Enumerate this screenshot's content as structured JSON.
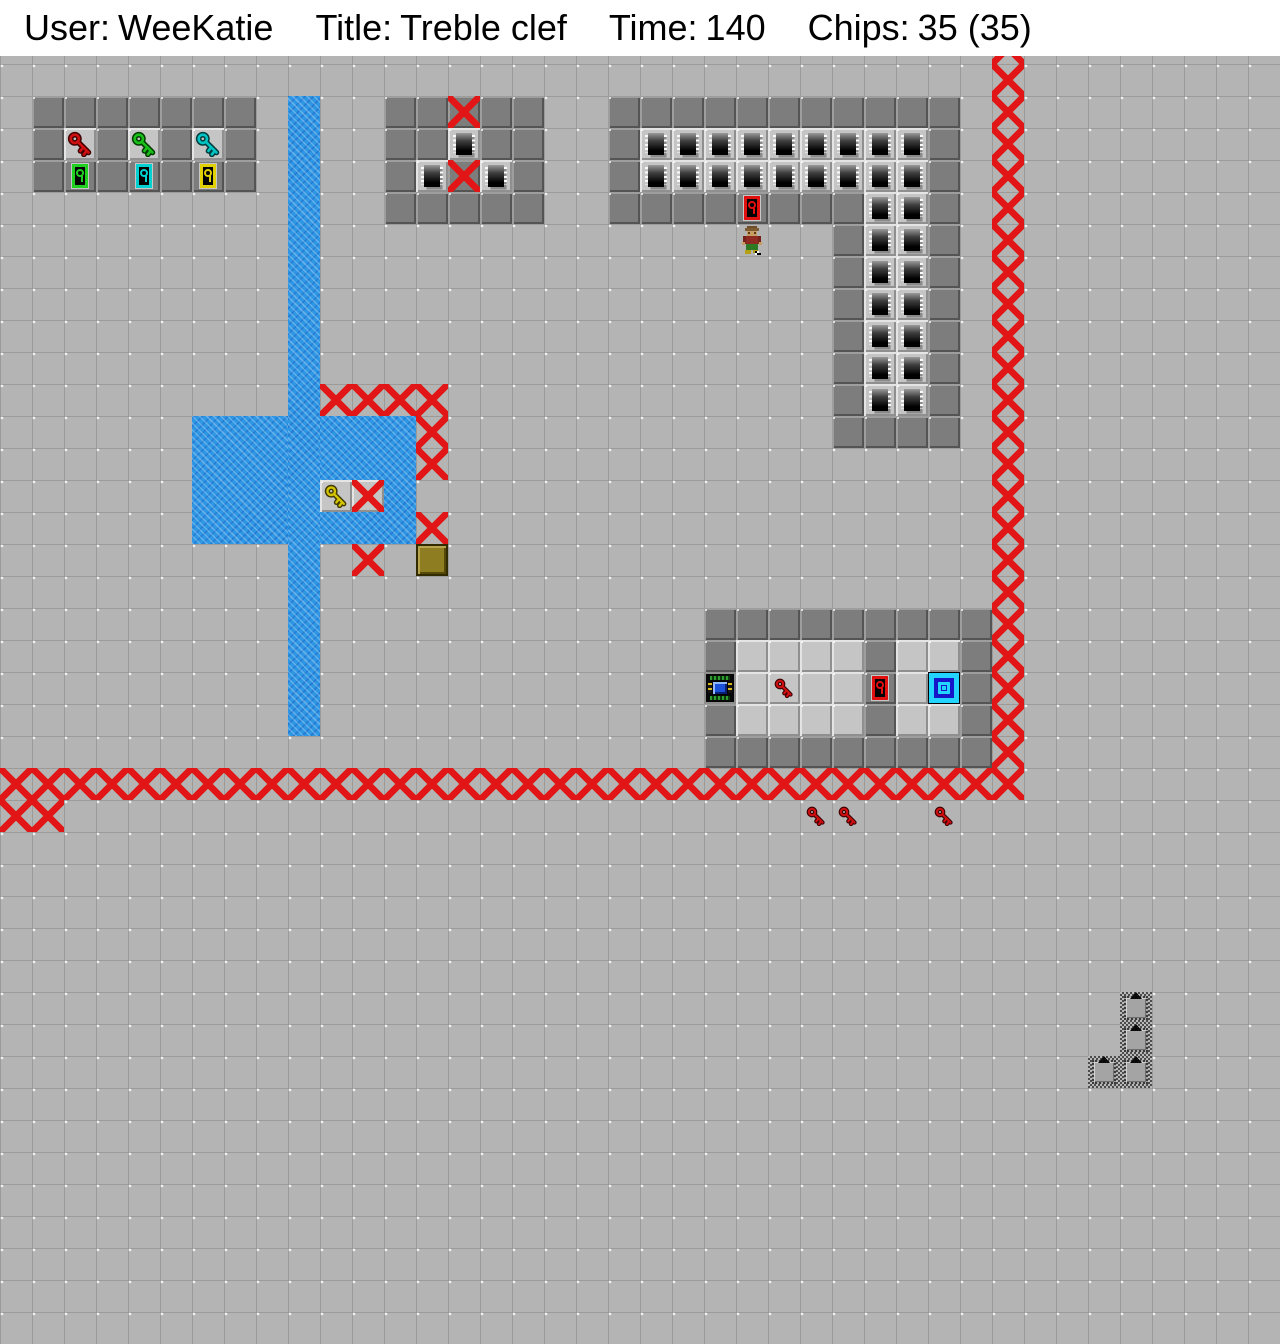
{
  "header": {
    "user_label": "User:",
    "user_value": "WeeKatie",
    "title_label": "Title:",
    "title_value": "Treble clef",
    "time_label": "Time:",
    "time_value": "140",
    "chips_label": "Chips:",
    "chips_value": "35 (35)"
  },
  "board": {
    "tile_size": 32,
    "cols": 40,
    "rows": 40,
    "colors": {
      "floor": "#b4b4b4",
      "room_floor": "#c5c5c5",
      "wall": "#7d7d7d",
      "x_marker": "#e21616",
      "water": "#2f96e4",
      "key_red": "#d01010",
      "key_green": "#18c018",
      "key_cyan": "#00c4c4",
      "key_yellow": "#d4c400",
      "lock_red": "#e01010",
      "lock_green": "#20d020",
      "lock_cyan": "#00d0d0",
      "lock_yellow": "#e0d000",
      "teleport_cyan": "#22d4ff",
      "teleport_blue": "#1616c8",
      "dirt": "#8f7d22"
    },
    "water_rects": [
      {
        "c": 9,
        "r": 1,
        "w": 1,
        "h": 20
      },
      {
        "c": 6,
        "r": 11,
        "w": 3,
        "h": 4
      },
      {
        "c": 10,
        "r": 11,
        "w": 3,
        "h": 4
      }
    ],
    "walls_h": [
      [
        1,
        7,
        1
      ],
      [
        1,
        1,
        2
      ],
      [
        3,
        3,
        2
      ],
      [
        5,
        5,
        2
      ],
      [
        7,
        7,
        2
      ],
      [
        1,
        1,
        3
      ],
      [
        3,
        3,
        3
      ],
      [
        5,
        5,
        3
      ],
      [
        7,
        7,
        3
      ],
      [
        12,
        13,
        1
      ],
      [
        15,
        16,
        1
      ],
      [
        12,
        13,
        2
      ],
      [
        15,
        16,
        2
      ],
      [
        12,
        12,
        3
      ],
      [
        16,
        16,
        3
      ],
      [
        12,
        16,
        4
      ],
      [
        19,
        29,
        1
      ],
      [
        19,
        19,
        2
      ],
      [
        29,
        29,
        2
      ],
      [
        19,
        19,
        3
      ],
      [
        29,
        29,
        3
      ],
      [
        19,
        22,
        4
      ],
      [
        24,
        26,
        4
      ],
      [
        29,
        29,
        4
      ],
      [
        26,
        26,
        5
      ],
      [
        29,
        29,
        5
      ],
      [
        26,
        26,
        6
      ],
      [
        29,
        29,
        6
      ],
      [
        26,
        26,
        7
      ],
      [
        29,
        29,
        7
      ],
      [
        26,
        26,
        8
      ],
      [
        29,
        29,
        8
      ],
      [
        26,
        26,
        9
      ],
      [
        29,
        29,
        9
      ],
      [
        26,
        26,
        10
      ],
      [
        29,
        29,
        10
      ],
      [
        26,
        29,
        11
      ],
      [
        22,
        30,
        17
      ],
      [
        22,
        22,
        18
      ],
      [
        27,
        27,
        18
      ],
      [
        30,
        30,
        18
      ],
      [
        30,
        30,
        19
      ],
      [
        22,
        22,
        20
      ],
      [
        27,
        27,
        20
      ],
      [
        30,
        30,
        20
      ],
      [
        22,
        30,
        21
      ]
    ],
    "wall_x": [
      [
        14,
        1
      ],
      [
        14,
        3
      ]
    ],
    "room_floor_tiles": [
      [
        23,
        18
      ],
      [
        24,
        18
      ],
      [
        25,
        18
      ],
      [
        26,
        18
      ],
      [
        28,
        18
      ],
      [
        29,
        18
      ],
      [
        23,
        19
      ],
      [
        25,
        19
      ],
      [
        26,
        19
      ],
      [
        28,
        19
      ],
      [
        23,
        20
      ],
      [
        24,
        20
      ],
      [
        25,
        20
      ],
      [
        26,
        20
      ],
      [
        28,
        20
      ],
      [
        29,
        20
      ]
    ],
    "room_floor_x": [
      [
        11,
        13
      ]
    ],
    "chip_runs": [
      [
        14,
        14,
        2
      ],
      [
        13,
        13,
        3
      ],
      [
        15,
        15,
        3
      ],
      [
        20,
        28,
        2
      ],
      [
        20,
        28,
        3
      ],
      [
        27,
        28,
        4
      ],
      [
        27,
        28,
        5
      ],
      [
        27,
        28,
        6
      ],
      [
        27,
        28,
        7
      ],
      [
        27,
        28,
        8
      ],
      [
        27,
        28,
        9
      ],
      [
        27,
        28,
        10
      ]
    ],
    "x_runs_h": [
      [
        10,
        13,
        10
      ],
      [
        13,
        13,
        11
      ],
      [
        13,
        13,
        12
      ],
      [
        13,
        13,
        14
      ],
      [
        11,
        11,
        15
      ],
      [
        0,
        31,
        22
      ],
      [
        0,
        1,
        23
      ]
    ],
    "x_runs_v": [
      [
        31,
        -1,
        21
      ]
    ],
    "keys": [
      {
        "c": 2,
        "r": 2,
        "color": "red",
        "size": 26,
        "bg": "room"
      },
      {
        "c": 4,
        "r": 2,
        "color": "green",
        "size": 26,
        "bg": "room"
      },
      {
        "c": 6,
        "r": 2,
        "color": "cyan",
        "size": 26,
        "bg": "room"
      },
      {
        "c": 10,
        "r": 13,
        "color": "yellow",
        "size": 24,
        "bg": "room"
      },
      {
        "c": 24,
        "r": 19,
        "color": "red",
        "size": 20,
        "bg": "room"
      },
      {
        "c": 25,
        "r": 23,
        "color": "red",
        "size": 20,
        "bg": "plain"
      },
      {
        "c": 26,
        "r": 23,
        "color": "red",
        "size": 20,
        "bg": "plain"
      },
      {
        "c": 29,
        "r": 23,
        "color": "red",
        "size": 20,
        "bg": "plain"
      }
    ],
    "locks": [
      {
        "c": 2,
        "r": 3,
        "color": "green"
      },
      {
        "c": 4,
        "r": 3,
        "color": "cyan"
      },
      {
        "c": 6,
        "r": 3,
        "color": "yellow"
      },
      {
        "c": 23,
        "r": 4,
        "color": "red"
      },
      {
        "c": 27,
        "r": 19,
        "color": "red"
      }
    ],
    "socket": {
      "c": 22,
      "r": 19
    },
    "teleport": {
      "c": 29,
      "r": 19
    },
    "dirt_block": {
      "c": 13,
      "r": 15
    },
    "hidden_walls": [
      [
        35,
        29
      ],
      [
        35,
        30
      ],
      [
        34,
        31
      ],
      [
        35,
        31
      ]
    ],
    "player": {
      "c": 23,
      "r": 5,
      "facing": "south"
    }
  }
}
